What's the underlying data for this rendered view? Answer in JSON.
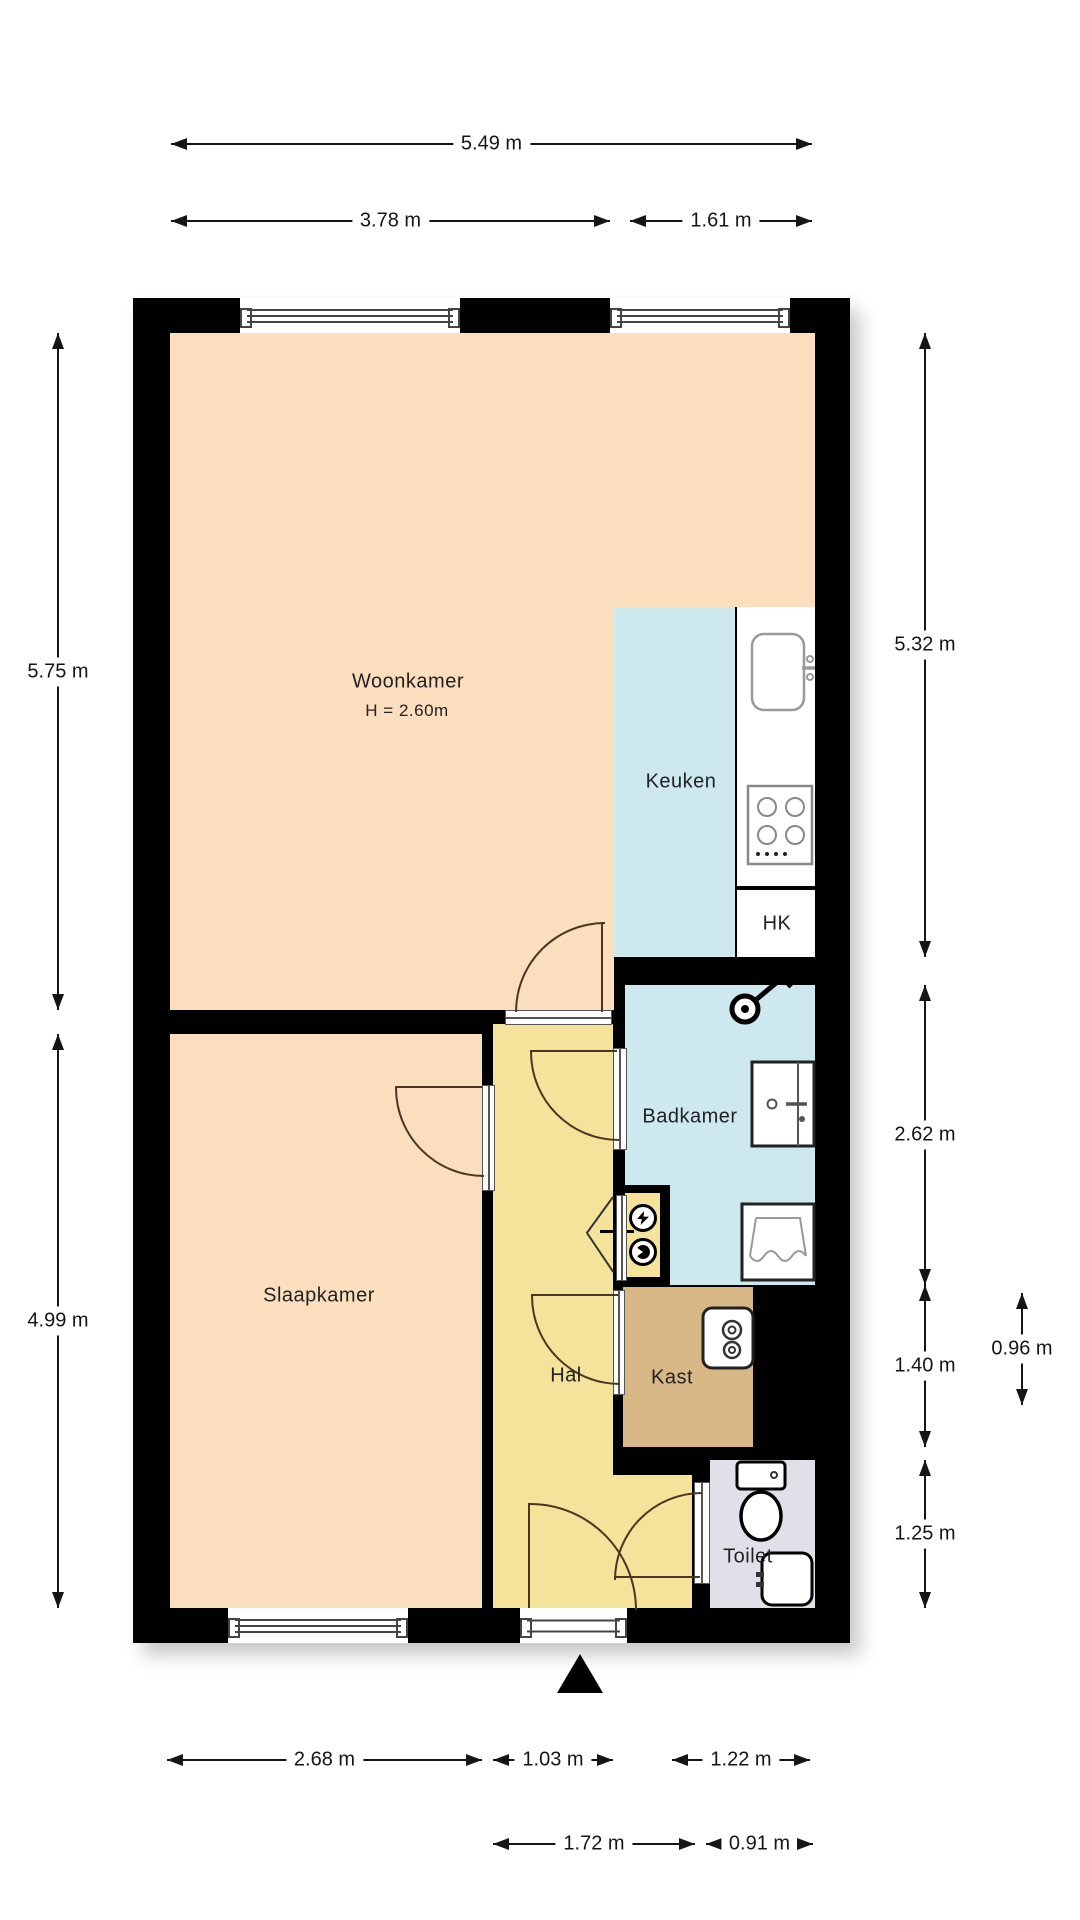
{
  "plan": {
    "type": "apartment-floor-plan",
    "rooms": {
      "woonkamer": {
        "label": "Woonkamer",
        "height_note": "H = 2.60m",
        "color": "#FBDEBD"
      },
      "keuken": {
        "label": "Keuken",
        "color": "#CDE8EF"
      },
      "hk": {
        "label": "HK",
        "color": "#FFFFFF"
      },
      "badkamer": {
        "label": "Badkamer",
        "color": "#CDE8EF"
      },
      "slaapkamer": {
        "label": "Slaapkamer",
        "color": "#FBDEBD"
      },
      "hal": {
        "label": "Hal",
        "color": "#F6E39B"
      },
      "kast": {
        "label": "Kast",
        "color": "#D9B888"
      },
      "toilet": {
        "label": "Toilet",
        "color": "#E0E0E8"
      }
    },
    "dims": {
      "total_width": "5.49 m",
      "woonkamer_width": "3.78 m",
      "keuken_width": "1.61 m",
      "woonkamer_height": "5.75 m",
      "slaapkamer_height": "4.99 m",
      "keuken_height": "5.32 m",
      "badkamer_height": "2.62 m",
      "kast_height": "1.40 m",
      "kast_width": "0.96 m",
      "toilet_height": "1.25 m",
      "slaapkamer_width": "2.68 m",
      "hal_width": "1.03 m",
      "toilet_top_width": "1.22 m",
      "hal_entry_width": "1.72 m",
      "toilet_width": "0.91 m"
    },
    "colors": {
      "wall": "#000000",
      "background": "#FFFFFF"
    },
    "icons": [
      "kitchen-sink-icon",
      "stove-icon",
      "shower-icon",
      "washbasin-icon",
      "laundry-sink-icon",
      "boiler-icon",
      "electric-meter-icon",
      "water-meter-icon",
      "toilet-icon",
      "hand-basin-icon",
      "entrance-arrow-icon"
    ]
  }
}
